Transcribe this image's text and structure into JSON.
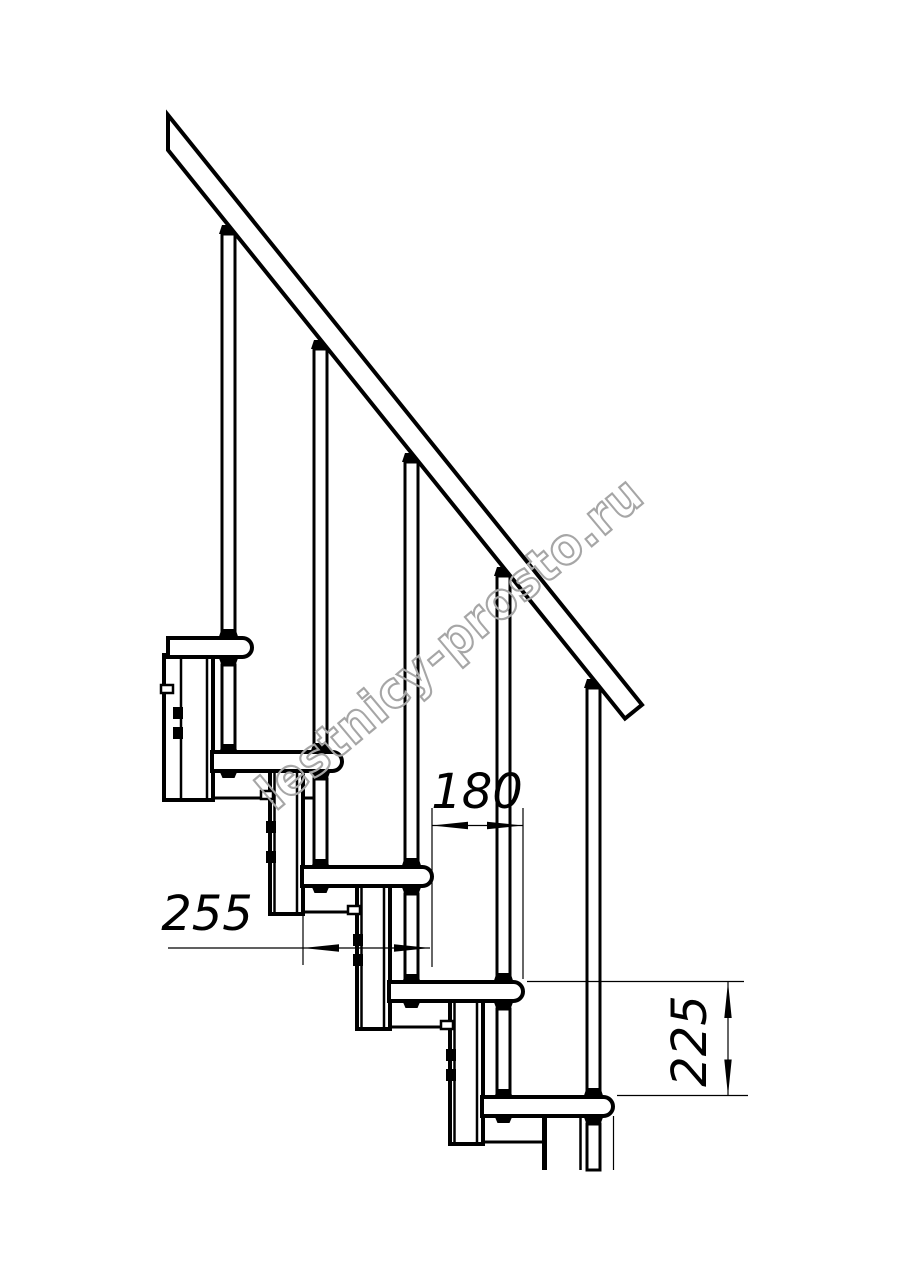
{
  "drawing": {
    "watermark": {
      "text": "lestnicy-prosto.ru"
    },
    "dimensions": {
      "step_run": {
        "value": "180"
      },
      "tread_depth": {
        "value": "255"
      },
      "step_rise": {
        "value": "225"
      }
    }
  },
  "colors": {
    "line": "#000000",
    "background": "#ffffff",
    "watermark": "#a6a6a6"
  }
}
